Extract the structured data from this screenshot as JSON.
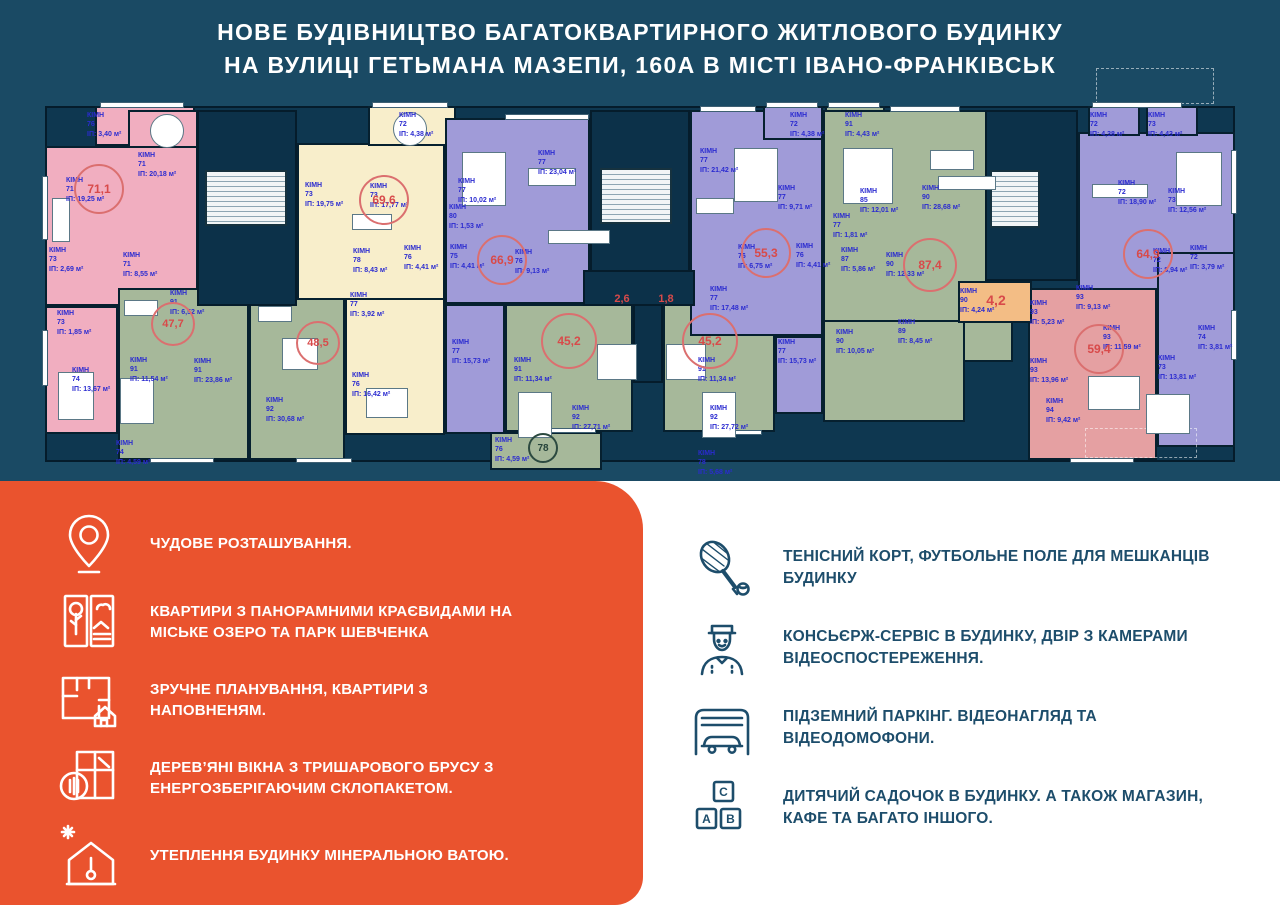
{
  "header": {
    "title_line1": "НОВЕ БУДІВНИЦТВО БАГАТОКВАРТИРНОГО ЖИТЛОВОГО БУДИНКУ",
    "title_line2": "НА ВУЛИЦІ ГЕТЬМАНА МАЗЕПИ, 160А В МІСТІ ІВАНО-ФРАНКІВСЬК"
  },
  "colors": {
    "navy_bg": "#1a4a64",
    "plan_base": "#0e3750",
    "wall": "#06202f",
    "pink": "#f1aec0",
    "cream": "#f8eecb",
    "purple": "#a09bd8",
    "green": "#a6b89a",
    "salmon": "#e5a0a2",
    "orange": "#f3bd85",
    "accent_orange": "#ea532e",
    "label_blue": "#2b2bd0",
    "area_red": "#d84a4a",
    "feature_navy": "#1d4d6b"
  },
  "floor_plan": {
    "label_word": "КІМН",
    "area_prefix": "ІП:",
    "area_suffix": "м²",
    "base": [
      45,
      106,
      1190,
      356
    ],
    "units": [
      {
        "id": "balcony-76",
        "color": "pink",
        "r": [
          95,
          106,
          100,
          40
        ]
      },
      {
        "id": "kitchen-71",
        "color": "pink",
        "r": [
          128,
          110,
          70,
          42
        ]
      },
      {
        "id": "living-71",
        "color": "pink",
        "r": [
          45,
          146,
          153,
          160
        ]
      },
      {
        "id": "lower-74",
        "color": "pink",
        "r": [
          45,
          306,
          73,
          128
        ]
      },
      {
        "id": "unit-47",
        "color": "green",
        "r": [
          118,
          288,
          131,
          172
        ]
      },
      {
        "id": "unit-48",
        "color": "green",
        "r": [
          249,
          298,
          96,
          162
        ]
      },
      {
        "id": "unit-69-top",
        "color": "cream",
        "r": [
          297,
          143,
          148,
          157
        ]
      },
      {
        "id": "unit-69-low",
        "color": "cream",
        "r": [
          345,
          298,
          100,
          137
        ]
      },
      {
        "id": "balcony-72",
        "color": "cream",
        "r": [
          368,
          106,
          88,
          40
        ]
      },
      {
        "id": "unit-66",
        "color": "purple",
        "r": [
          445,
          118,
          145,
          186
        ]
      },
      {
        "id": "unit-66-low",
        "color": "purple",
        "r": [
          445,
          304,
          60,
          130
        ]
      },
      {
        "id": "unit-45a",
        "color": "green",
        "r": [
          505,
          304,
          128,
          128
        ]
      },
      {
        "id": "unit-45b",
        "color": "green",
        "r": [
          663,
          304,
          112,
          128
        ]
      },
      {
        "id": "balcony-78",
        "color": "green",
        "r": [
          490,
          432,
          112,
          38
        ]
      },
      {
        "id": "unit-55",
        "color": "purple",
        "r": [
          690,
          110,
          133,
          226
        ]
      },
      {
        "id": "unit-55-low",
        "color": "purple",
        "r": [
          775,
          336,
          48,
          78
        ]
      },
      {
        "id": "balcony-72b",
        "color": "purple",
        "r": [
          763,
          106,
          60,
          34
        ]
      },
      {
        "id": "balcony-91",
        "color": "green",
        "r": [
          825,
          106,
          60,
          34
        ]
      },
      {
        "id": "unit-87",
        "color": "green",
        "r": [
          823,
          110,
          190,
          252
        ]
      },
      {
        "id": "unit-90",
        "color": "green",
        "r": [
          823,
          320,
          142,
          102
        ]
      },
      {
        "id": "unit-64",
        "color": "purple",
        "r": [
          1078,
          132,
          157,
          172
        ]
      },
      {
        "id": "balcony-r1",
        "color": "purple",
        "r": [
          1088,
          106,
          52,
          30
        ]
      },
      {
        "id": "balcony-r2",
        "color": "purple",
        "r": [
          1146,
          106,
          52,
          30
        ]
      },
      {
        "id": "unit-right-col",
        "color": "purple",
        "r": [
          1157,
          252,
          78,
          195
        ]
      },
      {
        "id": "unit-59",
        "color": "salmon",
        "r": [
          1028,
          288,
          129,
          172
        ]
      },
      {
        "id": "room-42",
        "color": "orange",
        "r": [
          958,
          281,
          74,
          42
        ]
      }
    ],
    "cores": [
      [
        197,
        110,
        100,
        196
      ],
      [
        590,
        110,
        100,
        196
      ],
      [
        985,
        110,
        93,
        171
      ],
      [
        633,
        303,
        30,
        80
      ],
      [
        583,
        270,
        112,
        36
      ]
    ],
    "stairs": [
      [
        205,
        170,
        82,
        56
      ],
      [
        600,
        168,
        72,
        56
      ],
      [
        990,
        170,
        50,
        58
      ]
    ],
    "terraces": [
      [
        1096,
        68,
        118,
        36
      ],
      [
        1085,
        428,
        112,
        30
      ]
    ],
    "windows": [
      [
        100,
        102,
        84,
        6
      ],
      [
        372,
        102,
        76,
        6
      ],
      [
        505,
        114,
        84,
        6
      ],
      [
        700,
        106,
        56,
        6
      ],
      [
        766,
        102,
        52,
        6
      ],
      [
        828,
        102,
        52,
        6
      ],
      [
        890,
        106,
        70,
        6
      ],
      [
        1092,
        102,
        90,
        6
      ],
      [
        42,
        176,
        6,
        64
      ],
      [
        42,
        330,
        6,
        56
      ],
      [
        1231,
        150,
        6,
        64
      ],
      [
        1231,
        310,
        6,
        50
      ],
      [
        150,
        458,
        64,
        5
      ],
      [
        296,
        458,
        56,
        5
      ],
      [
        540,
        428,
        56,
        5
      ],
      [
        706,
        430,
        56,
        5
      ],
      [
        1070,
        458,
        64,
        5
      ]
    ],
    "furniture": [
      [
        150,
        114,
        34,
        34,
        "round"
      ],
      [
        52,
        198,
        18,
        44,
        "rect"
      ],
      [
        58,
        372,
        36,
        48,
        "rect"
      ],
      [
        393,
        112,
        34,
        34,
        "round"
      ],
      [
        352,
        214,
        40,
        16,
        "rect"
      ],
      [
        366,
        388,
        42,
        30,
        "rect"
      ],
      [
        462,
        152,
        44,
        54,
        "rect"
      ],
      [
        528,
        168,
        48,
        18,
        "rect"
      ],
      [
        548,
        230,
        62,
        14,
        "rect"
      ],
      [
        597,
        344,
        40,
        36,
        "rect"
      ],
      [
        666,
        344,
        40,
        36,
        "rect"
      ],
      [
        518,
        392,
        34,
        46,
        "rect"
      ],
      [
        702,
        392,
        34,
        46,
        "rect"
      ],
      [
        734,
        148,
        44,
        54,
        "rect"
      ],
      [
        696,
        198,
        38,
        16,
        "rect"
      ],
      [
        843,
        148,
        50,
        56,
        "rect"
      ],
      [
        930,
        150,
        44,
        20,
        "rect"
      ],
      [
        938,
        176,
        58,
        14,
        "rect"
      ],
      [
        1176,
        152,
        46,
        54,
        "rect"
      ],
      [
        1092,
        184,
        56,
        14,
        "rect"
      ],
      [
        1088,
        376,
        52,
        34,
        "rect"
      ],
      [
        1146,
        394,
        44,
        40,
        "rect"
      ],
      [
        124,
        300,
        34,
        16,
        "rect"
      ],
      [
        120,
        378,
        34,
        46,
        "rect"
      ],
      [
        258,
        306,
        34,
        16,
        "rect"
      ],
      [
        282,
        338,
        36,
        32,
        "rect"
      ]
    ],
    "room_labels": [
      {
        "n": "76",
        "a": "3,40",
        "x": 87,
        "y": 111
      },
      {
        "n": "71",
        "a": "20,18",
        "x": 138,
        "y": 151
      },
      {
        "n": "71",
        "a": "19,25",
        "x": 66,
        "y": 176
      },
      {
        "n": "71",
        "a": "8,55",
        "x": 123,
        "y": 251
      },
      {
        "n": "73",
        "a": "2,69",
        "x": 49,
        "y": 246
      },
      {
        "n": "73",
        "a": "1,85",
        "x": 57,
        "y": 309
      },
      {
        "n": "74",
        "a": "13,67",
        "x": 72,
        "y": 366
      },
      {
        "n": "72",
        "a": "4,38",
        "x": 399,
        "y": 111
      },
      {
        "n": "73",
        "a": "19,75",
        "x": 305,
        "y": 181
      },
      {
        "n": "73",
        "a": "17,77",
        "x": 370,
        "y": 182
      },
      {
        "n": "78",
        "a": "8,43",
        "x": 353,
        "y": 247
      },
      {
        "n": "76",
        "a": "4,41",
        "x": 404,
        "y": 244
      },
      {
        "n": "77",
        "a": "3,92",
        "x": 350,
        "y": 291
      },
      {
        "n": "76",
        "a": "16,42",
        "x": 352,
        "y": 371
      },
      {
        "n": "77",
        "a": "10,02",
        "x": 458,
        "y": 177
      },
      {
        "n": "77",
        "a": "23,04",
        "x": 538,
        "y": 149
      },
      {
        "n": "80",
        "a": "1,53",
        "x": 449,
        "y": 203
      },
      {
        "n": "75",
        "a": "4,41",
        "x": 450,
        "y": 243
      },
      {
        "n": "76",
        "a": "9,13",
        "x": 515,
        "y": 248
      },
      {
        "n": "77",
        "a": "15,73",
        "x": 452,
        "y": 338
      },
      {
        "n": "91",
        "a": "6,52",
        "x": 170,
        "y": 289
      },
      {
        "n": "91",
        "a": "11,54",
        "x": 130,
        "y": 356
      },
      {
        "n": "91",
        "a": "23,86",
        "x": 194,
        "y": 357
      },
      {
        "n": "92",
        "a": "30,68",
        "x": 266,
        "y": 396
      },
      {
        "n": "74",
        "a": "4,59",
        "x": 116,
        "y": 439
      },
      {
        "n": "91",
        "a": "11,34",
        "x": 514,
        "y": 356
      },
      {
        "n": "92",
        "a": "27,71",
        "x": 572,
        "y": 404
      },
      {
        "n": "91",
        "a": "11,34",
        "x": 698,
        "y": 356
      },
      {
        "n": "92",
        "a": "27,72",
        "x": 710,
        "y": 404
      },
      {
        "n": "76",
        "a": "4,59",
        "x": 495,
        "y": 436
      },
      {
        "n": "72",
        "a": "4,38",
        "x": 790,
        "y": 111
      },
      {
        "n": "77",
        "a": "21,42",
        "x": 700,
        "y": 147
      },
      {
        "n": "77",
        "a": "9,71",
        "x": 778,
        "y": 184
      },
      {
        "n": "77",
        "a": "1,81",
        "x": 833,
        "y": 212
      },
      {
        "n": "76",
        "a": "6,75",
        "x": 738,
        "y": 243
      },
      {
        "n": "76",
        "a": "4,41",
        "x": 796,
        "y": 242
      },
      {
        "n": "77",
        "a": "17,48",
        "x": 710,
        "y": 285
      },
      {
        "n": "77",
        "a": "15,73",
        "x": 778,
        "y": 338
      },
      {
        "n": "91",
        "a": "4,43",
        "x": 845,
        "y": 111
      },
      {
        "n": "85",
        "a": "12,01",
        "x": 860,
        "y": 187
      },
      {
        "n": "90",
        "a": "28,68",
        "x": 922,
        "y": 184
      },
      {
        "n": "87",
        "a": "5,86",
        "x": 841,
        "y": 246
      },
      {
        "n": "90",
        "a": "12,33",
        "x": 886,
        "y": 251
      },
      {
        "n": "90",
        "a": "10,05",
        "x": 836,
        "y": 328
      },
      {
        "n": "89",
        "a": "8,45",
        "x": 898,
        "y": 318
      },
      {
        "n": "90",
        "a": "4,24",
        "x": 960,
        "y": 287
      },
      {
        "n": "72",
        "a": "4,38",
        "x": 1090,
        "y": 111
      },
      {
        "n": "73",
        "a": "4,43",
        "x": 1148,
        "y": 111
      },
      {
        "n": "72",
        "a": "18,90",
        "x": 1118,
        "y": 179
      },
      {
        "n": "73",
        "a": "12,56",
        "x": 1168,
        "y": 187
      },
      {
        "n": "72",
        "a": "8,94",
        "x": 1153,
        "y": 247
      },
      {
        "n": "72",
        "a": "3,79",
        "x": 1190,
        "y": 244
      },
      {
        "n": "74",
        "a": "3,81",
        "x": 1198,
        "y": 324
      },
      {
        "n": "73",
        "a": "13,81",
        "x": 1158,
        "y": 354
      },
      {
        "n": "93",
        "a": "9,13",
        "x": 1076,
        "y": 284
      },
      {
        "n": "93",
        "a": "5,23",
        "x": 1030,
        "y": 299
      },
      {
        "n": "93",
        "a": "11,59",
        "x": 1103,
        "y": 324
      },
      {
        "n": "93",
        "a": "13,96",
        "x": 1030,
        "y": 357
      },
      {
        "n": "94",
        "a": "9,42",
        "x": 1046,
        "y": 397
      },
      {
        "n": "78",
        "a": "5,68",
        "x": 698,
        "y": 449
      }
    ],
    "area_badges": [
      [
        "71,1",
        99,
        189,
        46,
        12,
        false
      ],
      [
        "69,6",
        384,
        200,
        46,
        12,
        false
      ],
      [
        "66,9",
        502,
        260,
        46,
        12,
        false
      ],
      [
        "47,7",
        173,
        324,
        40,
        11,
        false
      ],
      [
        "48,5",
        318,
        343,
        40,
        11,
        false
      ],
      [
        "45,2",
        569,
        341,
        52,
        12,
        false
      ],
      [
        "45,2",
        710,
        341,
        52,
        12,
        false
      ],
      [
        "55,3",
        766,
        253,
        46,
        12,
        false
      ],
      [
        "87,4",
        930,
        265,
        50,
        12,
        false
      ],
      [
        "64,9",
        1148,
        254,
        46,
        12,
        false
      ],
      [
        "59,4",
        1099,
        349,
        46,
        12,
        false
      ],
      [
        "4,2",
        996,
        300,
        0,
        14,
        false
      ],
      [
        "2,6",
        622,
        299,
        0,
        11,
        false
      ],
      [
        "1,8",
        666,
        299,
        0,
        11,
        false
      ],
      [
        "78",
        543,
        448,
        26,
        10,
        true
      ]
    ]
  },
  "features_left": {
    "items": [
      {
        "icon": "location-pin-icon",
        "text": "ЧУДОВЕ РОЗТАШУВАННЯ."
      },
      {
        "icon": "window-view-icon",
        "text": "КВАРТИРИ З ПАНОРАМНИМИ КРАЄВИДАМИ НА МІСЬКЕ ОЗЕРО ТА ПАРК ШЕВЧЕНКА"
      },
      {
        "icon": "floor-plan-icon",
        "text": "ЗРУЧНЕ ПЛАНУВАННЯ, КВАРТИРИ З НАПОВНЕНЯМ."
      },
      {
        "icon": "wooden-window-icon",
        "text": "ДЕРЕВ’ЯНІ ВІКНА З ТРИШАРОВОГО БРУСУ З ЕНЕРГОЗБЕРІГАЮЧИМ СКЛОПАКЕТОМ."
      },
      {
        "icon": "house-insulation-icon",
        "text": "УТЕПЛЕННЯ БУДИНКУ МІНЕРАЛЬНОЮ ВАТОЮ."
      }
    ]
  },
  "features_right": {
    "block_letters": [
      "C",
      "A",
      "B"
    ],
    "items": [
      {
        "icon": "tennis-racket-icon",
        "text": "ТЕНІСНИЙ КОРТ, ФУТБОЛЬНЕ ПОЛЕ ДЛЯ МЕШКАНЦІВ БУДИНКУ"
      },
      {
        "icon": "concierge-icon",
        "text": "КОНСЬЄРЖ-СЕРВІС В БУДИНКУ, ДВІР З КАМЕРАМИ ВІДЕОСПОСТЕРЕЖЕННЯ."
      },
      {
        "icon": "garage-icon",
        "text": "ПІДЗЕМНИЙ ПАРКІНГ. ВІДЕОНАГЛЯД ТА ВІДЕОДОМОФОНИ."
      },
      {
        "icon": "abc-blocks-icon",
        "text": "ДИТЯЧИЙ САДОЧОК В БУДИНКУ. А ТАКОЖ МАГАЗИН, КАФЕ ТА БАГАТО ІНШОГО."
      }
    ]
  }
}
